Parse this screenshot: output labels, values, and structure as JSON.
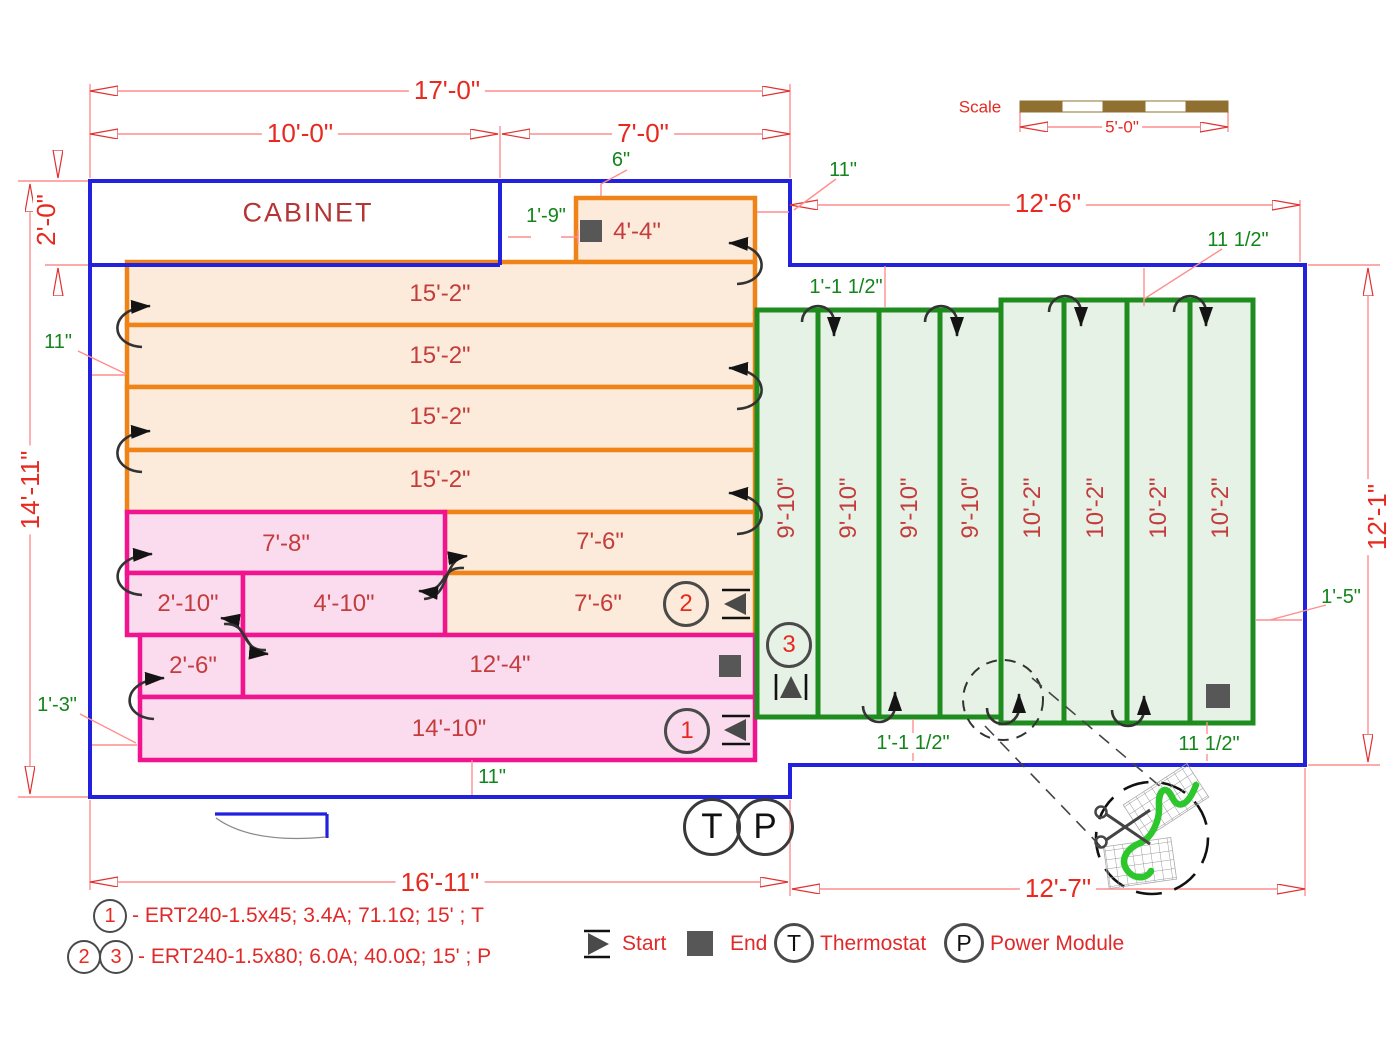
{
  "drawing": {
    "cabinet_label": "CABINET",
    "scale": {
      "caption": "Scale",
      "length": "5'-0\""
    }
  },
  "dims": {
    "top_total": "17'-0\"",
    "top_left": "10'-0\"",
    "top_right": "7'-0\"",
    "right_section_width": "12'-6\"",
    "bottom_left_width": "16'-11\"",
    "bottom_right_width": "12'-7\"",
    "left_height": "14'-11\"",
    "cabinet_depth": "2'-0\"",
    "right_height": "12'-1\""
  },
  "gaps": {
    "six_in": "6\"",
    "eleven_top": "11\"",
    "one_nine": "1'-9\"",
    "one_one_half_top": "1'-1 1/2\"",
    "eleven_half_top": "11 1/2\"",
    "eleven_left": "11\"",
    "one_three": "1'-3\"",
    "one_five": "1'-5\"",
    "eleven_bottom": "11\"",
    "one_one_half_bottom": "1'-1 1/2\"",
    "eleven_half_bottom": "11 1/2\""
  },
  "mats": {
    "o0": "4'-4\"",
    "o1": "15'-2\"",
    "o2": "15'-2\"",
    "o3": "15'-2\"",
    "o4": "15'-2\"",
    "o5": "7'-6\"",
    "o6": "7'-6\"",
    "p5": "7'-8\"",
    "p6a": "2'-10\"",
    "p6b": "4'-10\"",
    "p7a": "2'-6\"",
    "p7b": "12'-4\"",
    "p8": "14'-10\"",
    "g1": "9'-10\"",
    "g2": "9'-10\"",
    "g3": "9'-10\"",
    "g4": "9'-10\"",
    "g5": "10'-2\"",
    "g6": "10'-2\"",
    "g7": "10'-2\"",
    "g8": "10'-2\""
  },
  "markers": {
    "c1": "1",
    "c2": "2",
    "c3": "3",
    "thermostat": "T",
    "power": "P"
  },
  "legend": {
    "start": "Start",
    "end": "End",
    "thermostat": "Thermostat",
    "power": "Power Module",
    "t_letter": "T",
    "p_letter": "P",
    "specs": [
      {
        "m1": "1",
        "text": "- ERT240-1.5x45; 3.4A; 71.1Ω; 15' ; T"
      },
      {
        "m1": "2",
        "m2": "3",
        "text": "- ERT240-1.5x80; 6.0A; 40.0Ω; 15' ; P"
      }
    ]
  },
  "colors": {
    "wall_blue": "#2121DE",
    "orange_border": "#F08318",
    "orange_fill": "#FCEBDA",
    "pink_border": "#F2148E",
    "pink_fill": "#FBDCEF",
    "green_border": "#1F8C1F",
    "green_fill": "#E7F2E6",
    "dim_red_text": "#E8291F",
    "dim_line": "#FF8E8E",
    "label_crimson": "#C43C3C",
    "dim_green_text": "#12851B",
    "scale_brown": "#8F7031",
    "cable_arrow": "#333333"
  }
}
